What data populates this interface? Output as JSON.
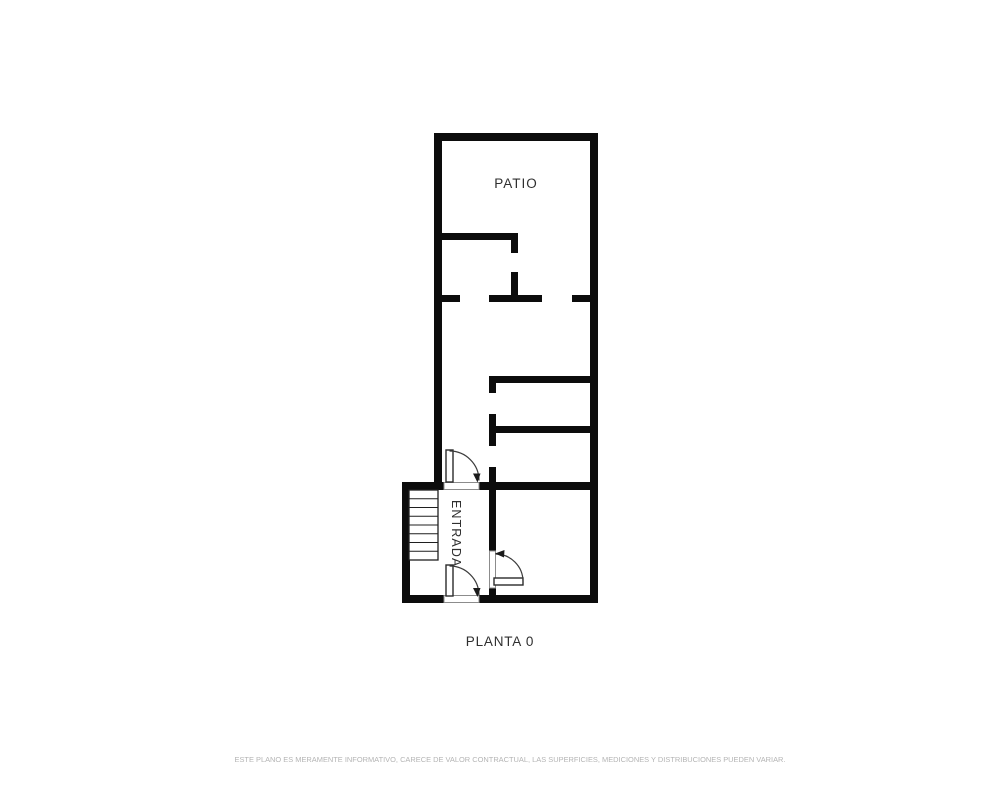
{
  "floorplan": {
    "labels": {
      "patio": "PATIO",
      "entrada": "ENTRADA"
    },
    "title": "PLANTA 0",
    "disclaimer": "ESTE PLANO ES MERAMENTE INFORMATIVO, CARECE DE VALOR CONTRACTUAL, LAS SUPERFICIES, MEDICIONES Y DISTRIBUCIONES PUEDEN VARIAR.",
    "colors": {
      "background": "#ffffff",
      "wall": "#0c0c0c",
      "label_text": "#2f2f2f",
      "disclaimer_text": "#b4b4b4"
    },
    "features": {
      "stairs_step_count": 8,
      "door_count": 3
    }
  }
}
